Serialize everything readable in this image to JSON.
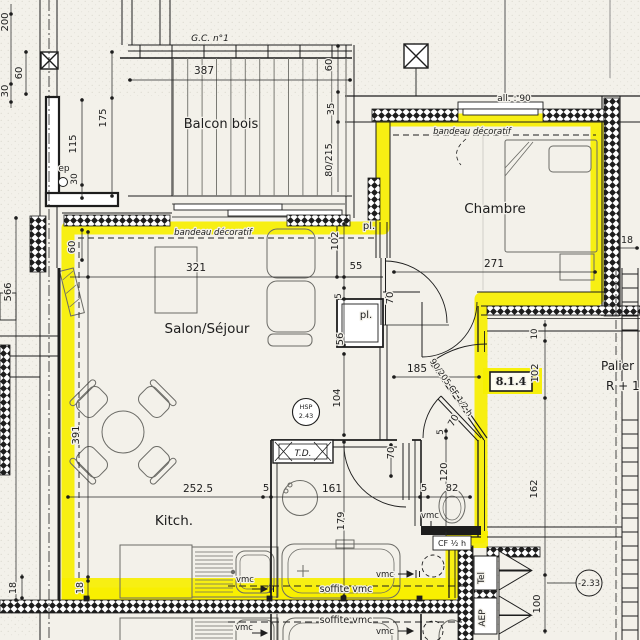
{
  "unit": {
    "number": "8.1.4"
  },
  "rooms": {
    "balcony": "Balcon bois",
    "bedroom": "Chambre",
    "living": "Salon/Séjour",
    "kitchen": "Kitch.",
    "landing_line1": "Palier",
    "landing_line2": "R + 1"
  },
  "notes": {
    "gc": "G.C. n°1",
    "bandeau_living": "bandeau décoratif",
    "bandeau_bedroom": "bandeau décoratif",
    "allege": "all. : 90",
    "ep": "ep",
    "pl_top": "pl.",
    "pl_bottom": "pl.",
    "td": "T.D.",
    "hsp_line1": "HSP",
    "hsp_line2": "2.43",
    "entry_door": "90/205 CF 1/2 h",
    "cf_wc": "CF ½ h",
    "vmc_wc": "vmc",
    "vmc_kitchen": "vmc",
    "vmc_bath": "vmc",
    "soffite_bath": "soffite vmc",
    "soffite_lower": "soffite vmc",
    "vmc_kitchen_lower": "vmc",
    "vmc_bath_lower": "vmc",
    "tel": "Tel",
    "aep": "AEP",
    "level": "-2.33"
  },
  "dims": {
    "d200": "200",
    "d30_left": "30",
    "d60_left": "60",
    "d387": "387",
    "d175": "175",
    "d115": "115",
    "d30_ep": "30",
    "d60_win": "60",
    "d35_win": "35",
    "d80_215": "80/215",
    "d102_closet": "102",
    "d55": "55",
    "d5_closet": "5",
    "d56": "56",
    "d70_doorA": "70",
    "d60_salon": "60",
    "d321": "321",
    "d566": "566",
    "d391": "391",
    "d271": "271",
    "d18_right": "18",
    "d185": "185",
    "d104": "104",
    "d10": "10",
    "d102_palier": "102",
    "d162": "162",
    "d100": "100",
    "d252_5": "252.5",
    "d5_kitchen": "5",
    "d161": "161",
    "d5_wc": "5",
    "d82": "82",
    "d179": "179",
    "d70_bath": "70",
    "d5_wc2": "5",
    "d120": "120",
    "d70_wc": "70",
    "d18_a": "18",
    "d18_b": "18"
  },
  "colors": {
    "highlight": "#f7ef00",
    "paper": "#f3f1ea",
    "ink": "#1d1d1d"
  }
}
